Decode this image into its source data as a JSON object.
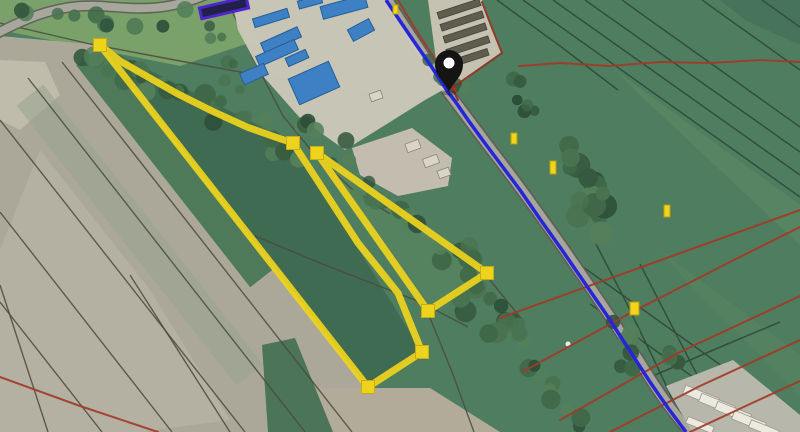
{
  "overlays": {
    "colors": {
      "parcel_yellow": "#eed31d",
      "parcel_yellow_edge": "#c9ad10",
      "route_blue": "#2526d8",
      "cadastral_red": "#a23928",
      "boundary_maroon": "#8d3220",
      "pin_black": "#141414",
      "marker_yellow": "#f0d41e"
    },
    "route": {
      "points": "386,0 400,21 415,43 431,66 448,92 455,101 468,120 484,142 502,166 520,190 540,219 562,250 584,282 606,314 628,348 650,382 668,408 686,432"
    },
    "parcels": {
      "large_points": "100,45 120,61 148,77 178,94 212,111 247,127 275,137 293,143 358,243 398,293 422,352 368,387",
      "small_points": "317,153 487,273 428,311",
      "vertex_squares": "M93.5,38.5h13v13h-13Z M286.5,136.5h13v13h-13Z M415.5,345.5h13v13h-13Z M361.5,380.5h13v13h-13Z M310.5,146.5h13v13h-13Z M480.5,266.5h13v13h-13Z M421.5,304.5h13v13h-13Z"
    },
    "pin": {
      "transform": "translate(449,92)"
    },
    "markers": [
      {
        "x": 511,
        "y": 133,
        "w": 6,
        "h": 11
      },
      {
        "x": 550,
        "y": 161,
        "w": 6,
        "h": 13
      },
      {
        "x": 664,
        "y": 205,
        "w": 6,
        "h": 12
      },
      {
        "x": 630,
        "y": 302,
        "w": 9,
        "h": 13
      },
      {
        "x": 393,
        "y": 5,
        "w": 5,
        "h": 9
      }
    ],
    "red_lines": {
      "r0": "398,0 416,30 437,62 452,84 456,92",
      "r2": "519,66 560,63 610,66 660,62 710,63 760,60 800,62",
      "r3": "522,372 640,308 730,262 800,227",
      "r4": "560,420 680,352 800,296",
      "r5": "610,432 700,386 800,340",
      "r6": "690,432 750,404 800,381",
      "r7": "0,377 80,406 158,432",
      "r8": "500,318 650,264 800,210"
    },
    "maroon_boundary": {
      "points": "482,2 492,28 502,53 452,88 458,100"
    }
  }
}
